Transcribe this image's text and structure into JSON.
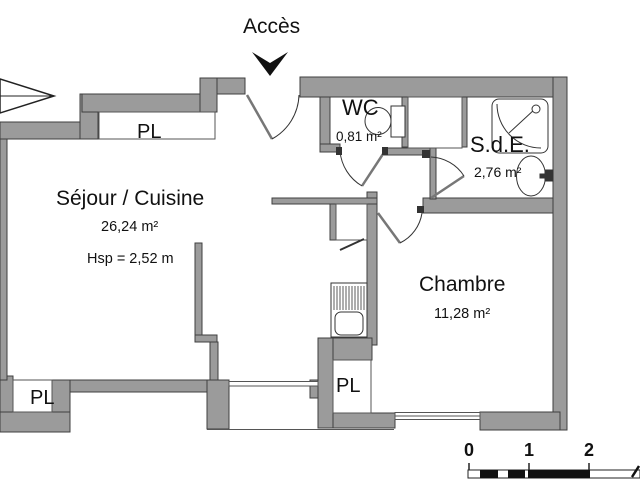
{
  "plan": {
    "access_label": "Accès",
    "rooms": {
      "sejour": {
        "name": "Séjour / Cuisine",
        "area": "26,24 m²",
        "ceiling": "Hsp = 2,52 m"
      },
      "chambre": {
        "name": "Chambre",
        "area": "11,28 m²"
      },
      "wc": {
        "name": "WC",
        "area": "0,81 m²"
      },
      "sde": {
        "name": "S.d.E.",
        "area": "2,76 m²"
      }
    },
    "closets": {
      "pl_top": "PL",
      "pl_bottom_left": "PL",
      "pl_middle": "PL"
    },
    "scale_bar": {
      "labels": [
        "0",
        "1",
        "2"
      ]
    },
    "colors": {
      "wall_fill": "#9b9b9b",
      "wall_outline": "#3f3f3f",
      "line_dark": "#333333",
      "arrow_black": "#111111",
      "background": "#ffffff"
    }
  }
}
